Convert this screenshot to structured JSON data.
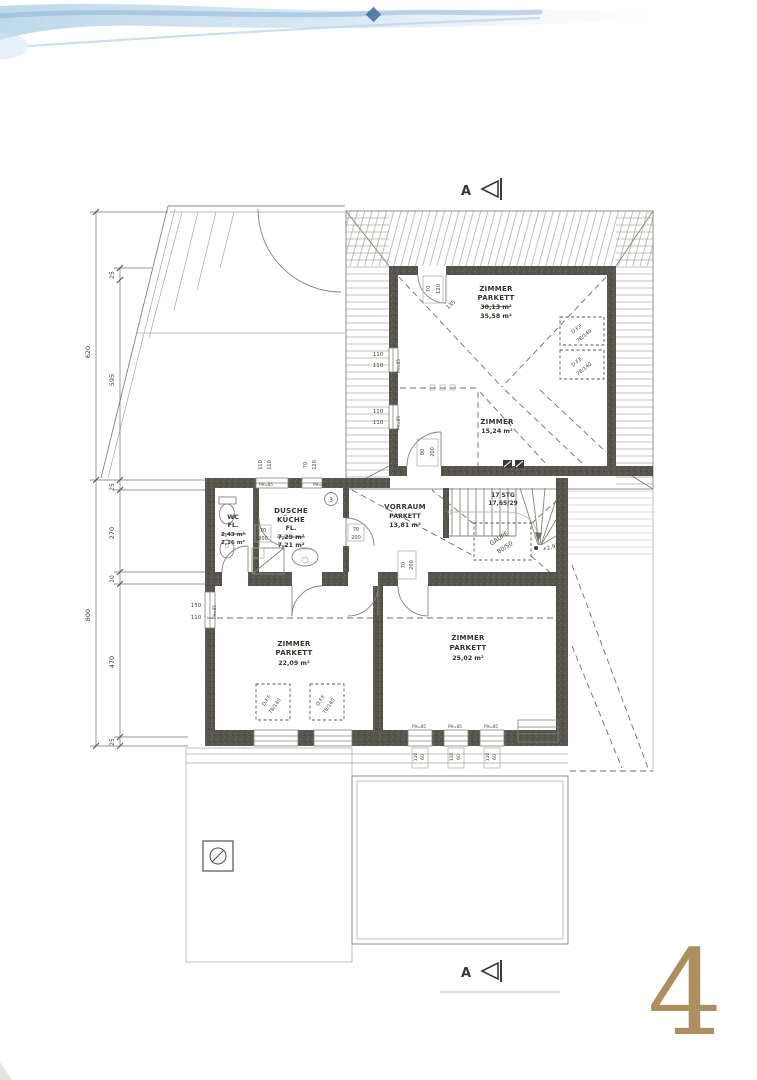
{
  "page": {
    "number": "4"
  },
  "section_markers": {
    "top": "A",
    "bottom": "A"
  },
  "kitchen_number": "3",
  "colors": {
    "paper": "#ffffff",
    "ink": "#3a3932",
    "wall": "#56544b",
    "swoosh": "#aecfe6",
    "page_number": "#a5834e"
  },
  "rooms": {
    "zimmer_top": {
      "name": "ZIMMER",
      "floor": "PARKETT",
      "area_old": "30,13 m²",
      "area": "35,58 m²"
    },
    "zimmer_top_small": {
      "name": "ZIMMER",
      "area": "15,24 m²"
    },
    "wc": {
      "name": "WC",
      "floor": "FL.",
      "area_old": "2,43 m²",
      "area": "2,16 m²"
    },
    "dusche_kueche": {
      "name": "DUSCHE",
      "name2": "KÜCHE",
      "floor": "FL.",
      "area_old": "7,29 m²",
      "area": "7,21 m²"
    },
    "vorraum": {
      "name": "VORRAUM",
      "floor": "PARKETT",
      "area": "13,81 m²"
    },
    "zimmer_left": {
      "name": "ZIMMER",
      "floor": "PARKETT",
      "area": "22,09 m²"
    },
    "zimmer_right": {
      "name": "ZIMMER",
      "floor": "PARKETT",
      "area": "25,02 m²"
    }
  },
  "stairs": {
    "label": "17 STG",
    "dim": "17,65/29"
  },
  "annotations": [
    {
      "t": "70",
      "x": 430,
      "y": 289,
      "r": -90,
      "s": 5.5
    },
    {
      "t": "120",
      "x": 440,
      "y": 289,
      "r": -90,
      "s": 5.5
    },
    {
      "t": "135",
      "x": 452,
      "y": 306,
      "r": -42,
      "s": 5.5
    },
    {
      "t": "110",
      "x": 378,
      "y": 356,
      "r": 0,
      "s": 5.5
    },
    {
      "t": "110",
      "x": 378,
      "y": 367,
      "r": 0,
      "s": 5.5
    },
    {
      "t": "PH=85",
      "x": 400,
      "y": 366,
      "r": -90,
      "s": 4
    },
    {
      "t": "110",
      "x": 378,
      "y": 413,
      "r": 0,
      "s": 5.5
    },
    {
      "t": "110",
      "x": 378,
      "y": 424,
      "r": 0,
      "s": 5.5
    },
    {
      "t": "PH=85",
      "x": 400,
      "y": 423,
      "r": -90,
      "s": 4
    },
    {
      "t": "80",
      "x": 424,
      "y": 452,
      "r": -90,
      "s": 5
    },
    {
      "t": "200",
      "x": 434,
      "y": 452,
      "r": -90,
      "s": 5
    },
    {
      "t": "110",
      "x": 262,
      "y": 465,
      "r": -90,
      "s": 5
    },
    {
      "t": "110",
      "x": 271,
      "y": 465,
      "r": -90,
      "s": 5
    },
    {
      "t": "70",
      "x": 307,
      "y": 465,
      "r": -90,
      "s": 5
    },
    {
      "t": "120",
      "x": 316,
      "y": 465,
      "r": -90,
      "s": 5
    },
    {
      "t": "PH=85",
      "x": 266,
      "y": 486,
      "r": 0,
      "s": 4
    },
    {
      "t": "PH=85",
      "x": 320,
      "y": 486,
      "r": 0,
      "s": 4
    },
    {
      "t": "70",
      "x": 263,
      "y": 532,
      "r": 0,
      "s": 5
    },
    {
      "t": "200",
      "x": 263,
      "y": 540,
      "r": 0,
      "s": 5
    },
    {
      "t": "70",
      "x": 356,
      "y": 531,
      "r": 0,
      "s": 5
    },
    {
      "t": "200",
      "x": 356,
      "y": 539,
      "r": 0,
      "s": 5
    },
    {
      "t": "70",
      "x": 405,
      "y": 565,
      "r": -90,
      "s": 5
    },
    {
      "t": "200",
      "x": 413,
      "y": 565,
      "r": -90,
      "s": 5
    },
    {
      "t": "150",
      "x": 196,
      "y": 607,
      "r": 0,
      "s": 5.5
    },
    {
      "t": "110",
      "x": 196,
      "y": 619,
      "r": 0,
      "s": 5.5
    },
    {
      "t": "PH=85",
      "x": 216,
      "y": 612,
      "r": -90,
      "s": 4
    },
    {
      "t": "PH=85",
      "x": 419,
      "y": 728,
      "r": 0,
      "s": 4
    },
    {
      "t": "PH=85",
      "x": 455,
      "y": 728,
      "r": 0,
      "s": 4
    },
    {
      "t": "PH=85",
      "x": 491,
      "y": 728,
      "r": 0,
      "s": 4
    },
    {
      "t": "110",
      "x": 417,
      "y": 757,
      "r": -90,
      "s": 4.5
    },
    {
      "t": "60",
      "x": 424,
      "y": 757,
      "r": -90,
      "s": 4.5
    },
    {
      "t": "110",
      "x": 453,
      "y": 757,
      "r": -90,
      "s": 4.5
    },
    {
      "t": "60",
      "x": 460,
      "y": 757,
      "r": -90,
      "s": 4.5
    },
    {
      "t": "110",
      "x": 489,
      "y": 757,
      "r": -90,
      "s": 4.5
    },
    {
      "t": "60",
      "x": 496,
      "y": 757,
      "r": -90,
      "s": 4.5
    },
    {
      "t": "25",
      "x": 114,
      "y": 275,
      "r": -90,
      "s": 6
    },
    {
      "t": "620",
      "x": 90,
      "y": 352,
      "r": -90,
      "s": 6.5
    },
    {
      "t": "595",
      "x": 114,
      "y": 380,
      "r": -90,
      "s": 6.5
    },
    {
      "t": "25",
      "x": 114,
      "y": 487,
      "r": -90,
      "s": 6
    },
    {
      "t": "270",
      "x": 114,
      "y": 533,
      "r": -90,
      "s": 6.5
    },
    {
      "t": "10",
      "x": 114,
      "y": 579,
      "r": -90,
      "s": 6
    },
    {
      "t": "800",
      "x": 90,
      "y": 615,
      "r": -90,
      "s": 6.5
    },
    {
      "t": "470",
      "x": 114,
      "y": 662,
      "r": -90,
      "s": 6.5
    },
    {
      "t": "25",
      "x": 114,
      "y": 742,
      "r": -90,
      "s": 6
    },
    {
      "t": "+2,93",
      "x": 551,
      "y": 549,
      "r": -15,
      "s": 5.5
    },
    {
      "t": "GAUPE",
      "x": 500,
      "y": 540,
      "r": -33,
      "s": 6
    },
    {
      "t": "80/50",
      "x": 506,
      "y": 549,
      "r": -33,
      "s": 6
    },
    {
      "t": "D.F.F.",
      "x": 578,
      "y": 330,
      "r": -38,
      "s": 5
    },
    {
      "t": "78/140",
      "x": 585,
      "y": 337,
      "r": -38,
      "s": 5
    },
    {
      "t": "D.F.F.",
      "x": 578,
      "y": 363,
      "r": -38,
      "s": 5
    },
    {
      "t": "78/140",
      "x": 585,
      "y": 370,
      "r": -38,
      "s": 5
    },
    {
      "t": "D.F.F.",
      "x": 268,
      "y": 701,
      "r": -55,
      "s": 5
    },
    {
      "t": "78/140",
      "x": 276,
      "y": 707,
      "r": -55,
      "s": 5
    },
    {
      "t": "D.F.F.",
      "x": 322,
      "y": 701,
      "r": -55,
      "s": 5
    },
    {
      "t": "78/140",
      "x": 330,
      "y": 707,
      "r": -55,
      "s": 5
    }
  ]
}
